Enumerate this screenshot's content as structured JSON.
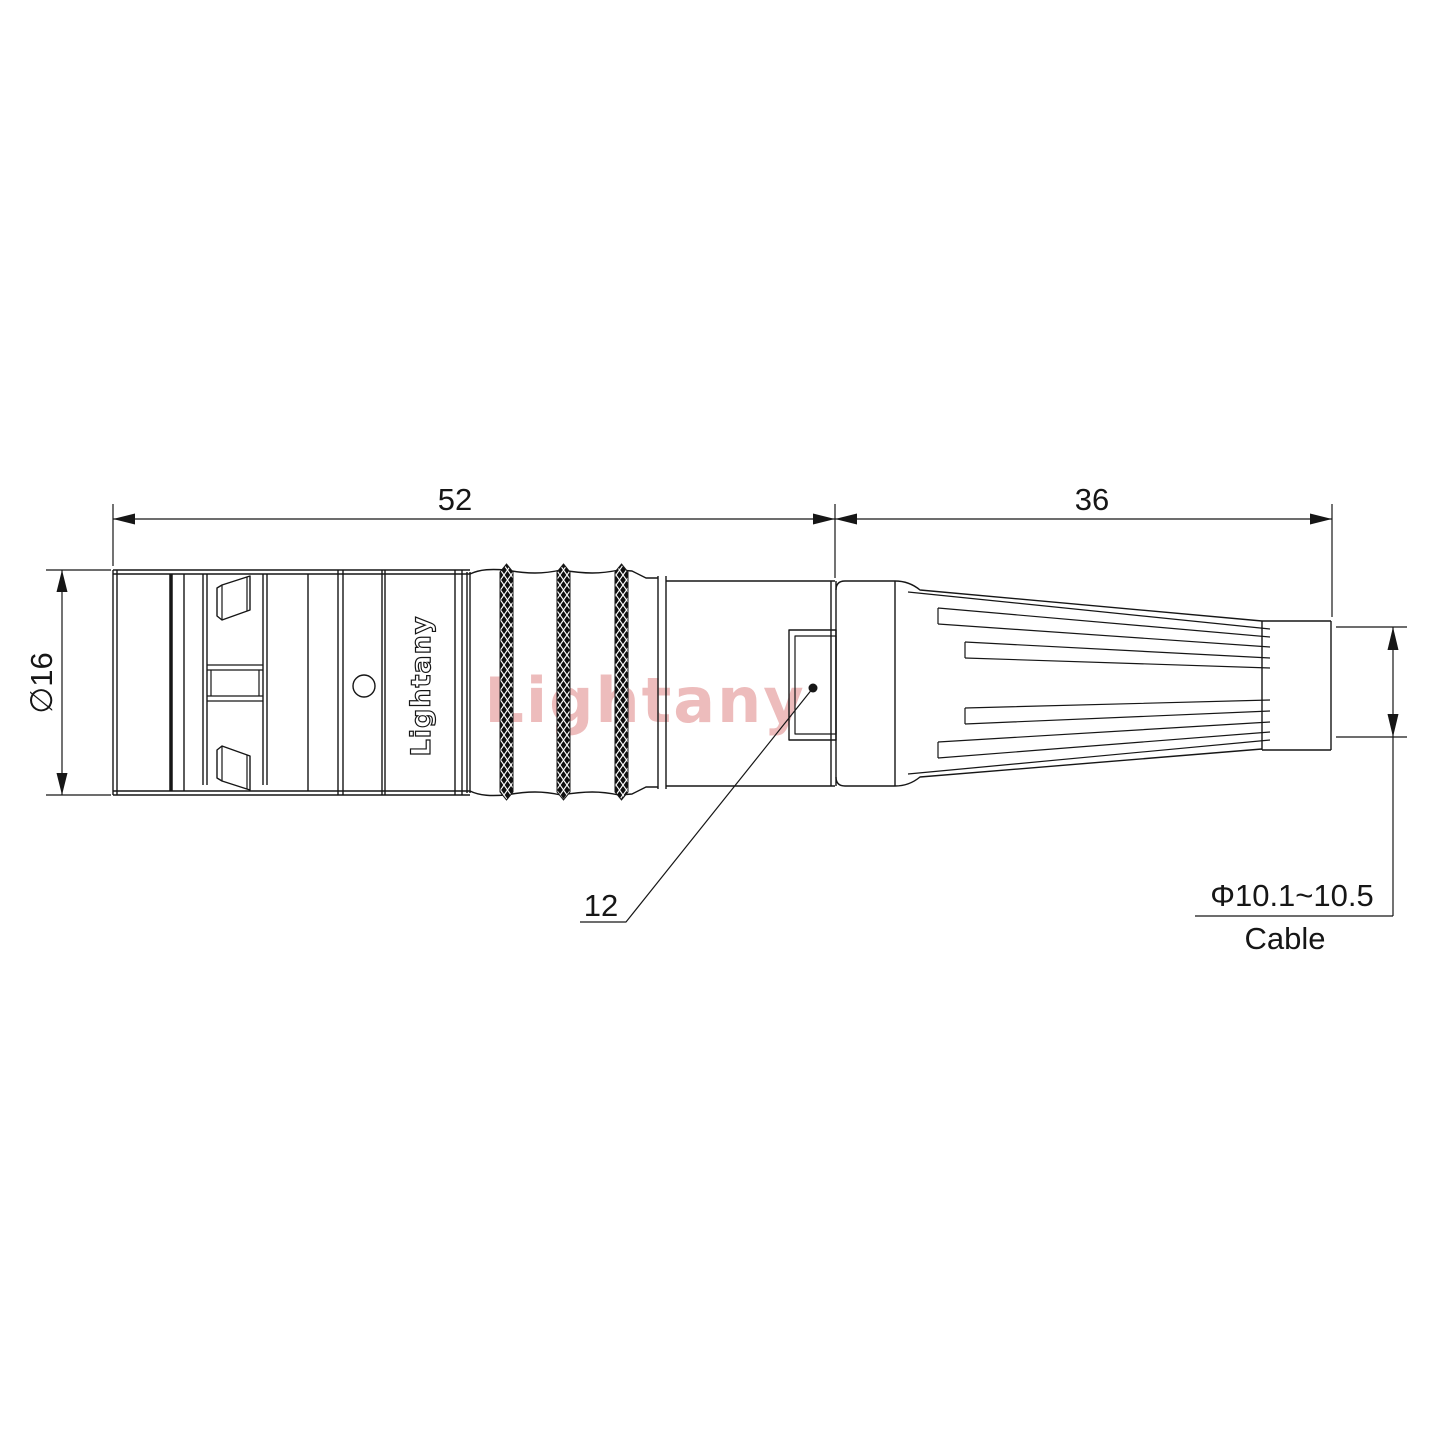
{
  "drawing": {
    "watermark": "Lightany",
    "engraving": "Lightany",
    "dimensions": {
      "front_length": "52",
      "boot_length": "36",
      "front_diameter": "∅16",
      "nut_flat": "12",
      "cable_diameter": "Φ10.1~10.5",
      "cable_label": "Cable"
    },
    "colors": {
      "line": "#161616",
      "watermark": "#edbcbc",
      "background": "#ffffff"
    }
  }
}
